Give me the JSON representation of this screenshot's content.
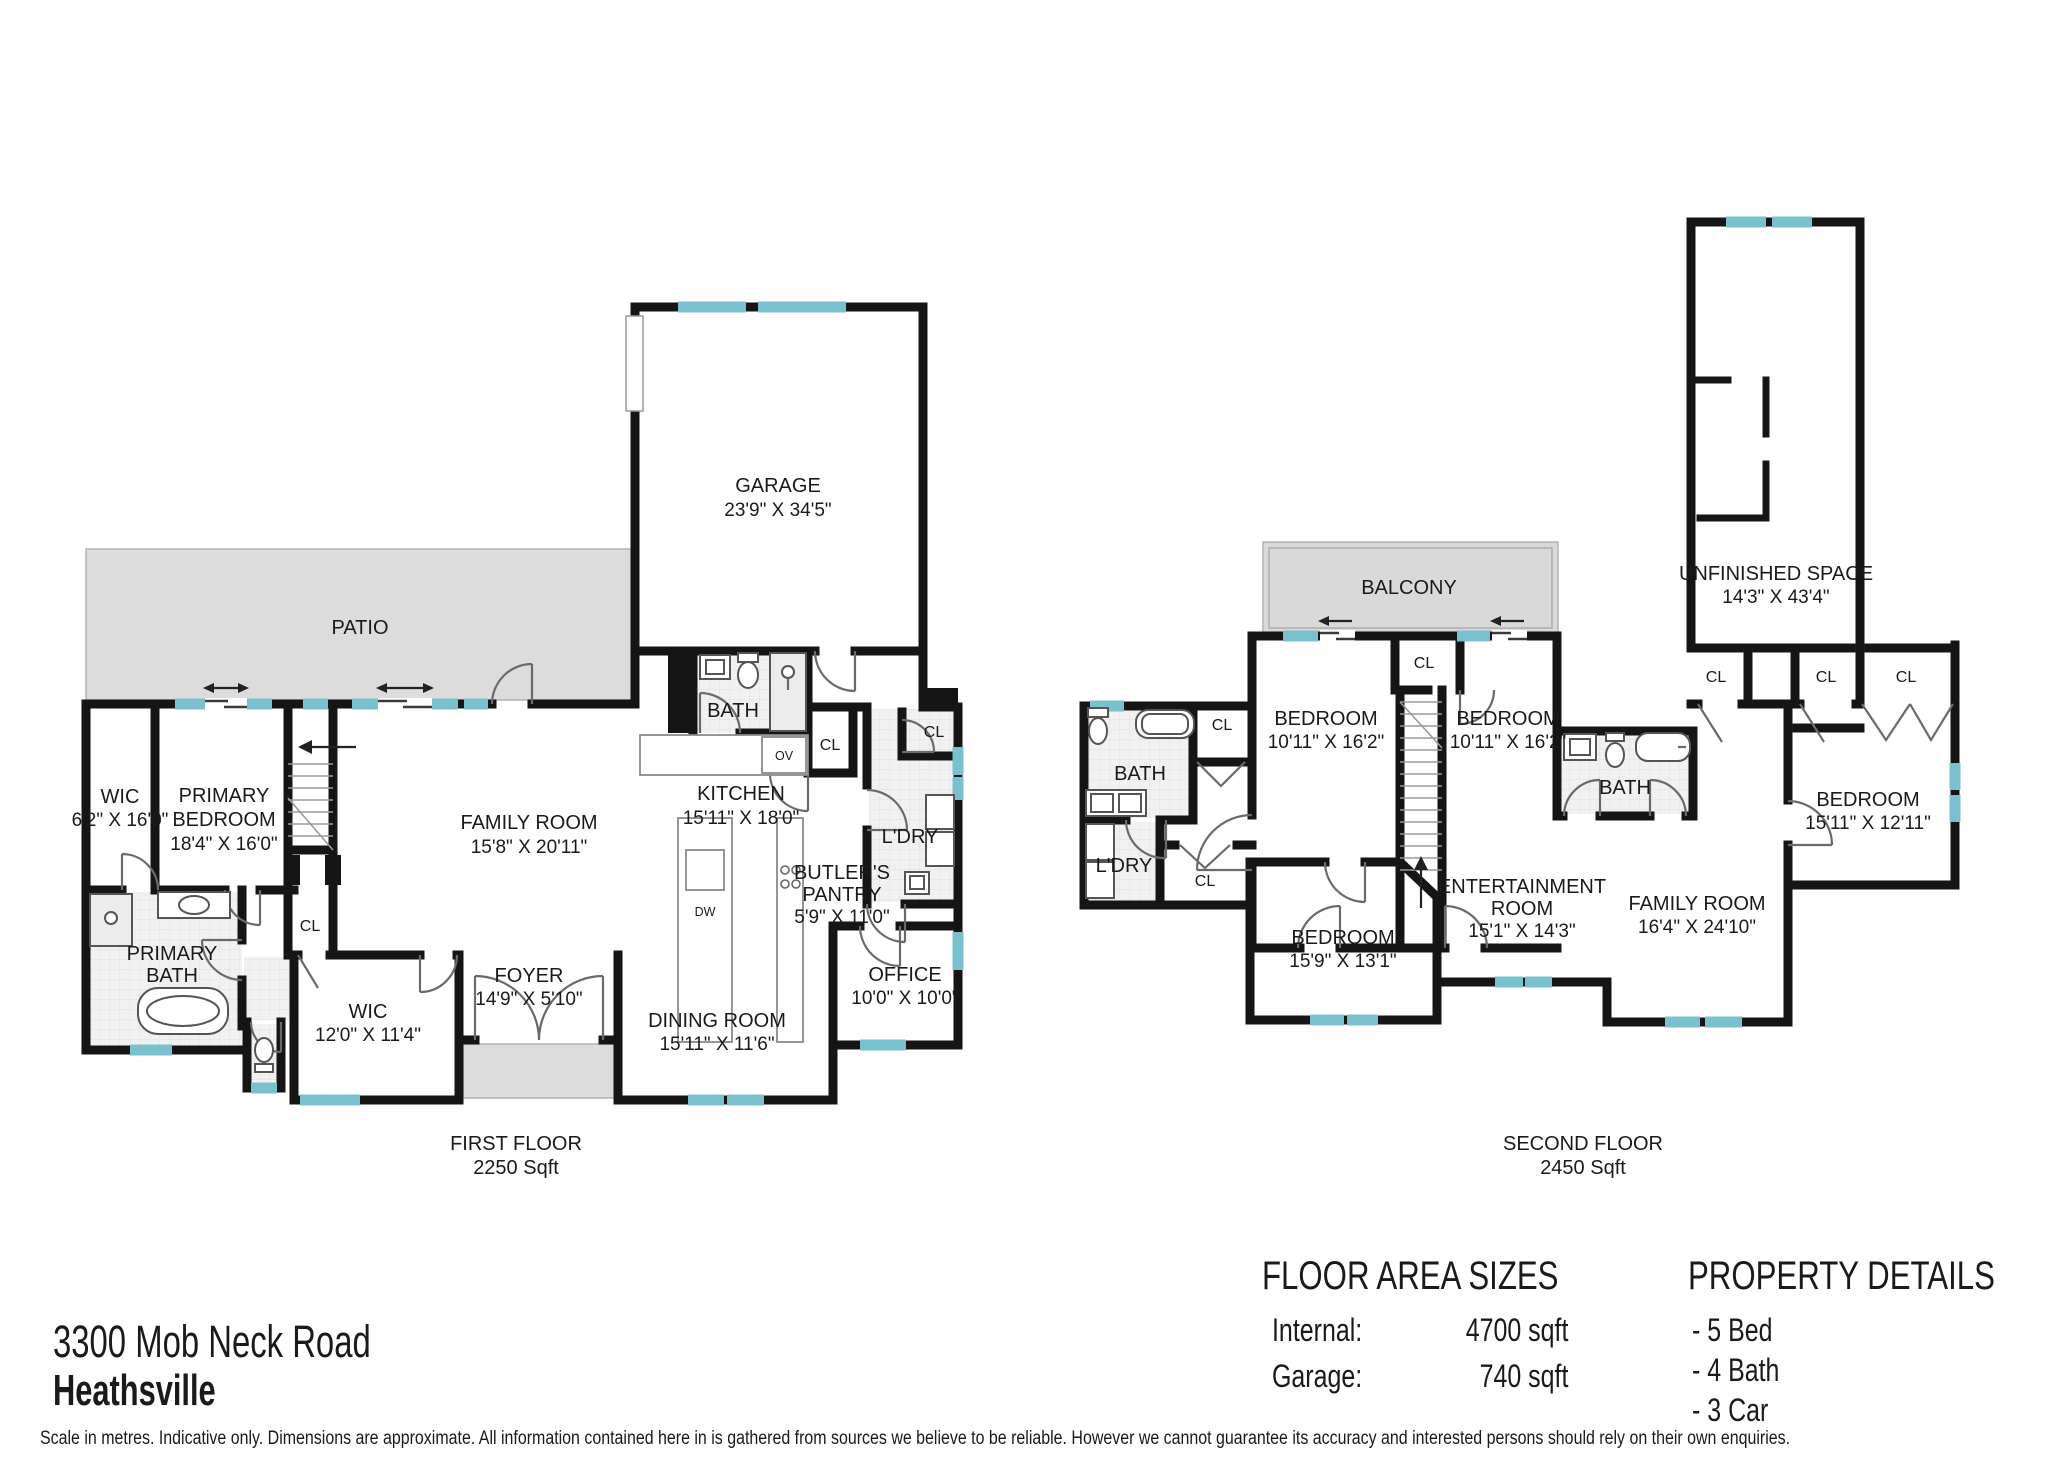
{
  "page_title": "Floor Plan",
  "colors": {
    "wall": "#151515",
    "window": "#79c1ce",
    "patio_fill": "#dcdcdd",
    "tile_fill": "#f1f1f1"
  },
  "address": {
    "line1": "3300 Mob Neck Road",
    "line2": "Heathsville"
  },
  "floor_area": {
    "title": "FLOOR AREA SIZES",
    "rows": [
      {
        "label": "Internal:",
        "value": "4700 sqft"
      },
      {
        "label": "Garage:",
        "value": "740 sqft"
      }
    ]
  },
  "property_details": {
    "title": "PROPERTY DETAILS",
    "items": [
      "- 5 Bed",
      "- 4 Bath",
      "- 3 Car"
    ]
  },
  "disclaimer": "Scale in metres. Indicative only. Dimensions are approximate. All information contained here in is gathered from sources we believe to be reliable. However we cannot guarantee its accuracy and interested persons should rely on their own enquiries.",
  "first_floor": {
    "title": "FIRST FLOOR",
    "area": "2250 Sqft",
    "rooms": {
      "patio": {
        "name": "PATIO"
      },
      "garage": {
        "name": "GARAGE",
        "dims": "23'9\" X 34'5\""
      },
      "bath": {
        "name": "BATH"
      },
      "oven": {
        "name": "OV"
      },
      "kitchen": {
        "name": "KITCHEN",
        "dims": "15'11\" X 18'0\""
      },
      "closet_a": {
        "name": "CL"
      },
      "closet_b": {
        "name": "CL"
      },
      "laundry": {
        "name": "L'DRY"
      },
      "butlers_pantry": {
        "name": "BUTLER'S PANTRY",
        "lines": [
          "BUTLER'S",
          "PANTRY"
        ],
        "dims": "5'9\" X 11'0\""
      },
      "dishwasher": {
        "name": "DW"
      },
      "family_room": {
        "name": "FAMILY ROOM",
        "dims": "15'8\" X 20'11\""
      },
      "primary_bedroom": {
        "name": "PRIMARY BEDROOM",
        "lines": [
          "PRIMARY",
          "BEDROOM"
        ],
        "dims": "18'4\" X 16'0\""
      },
      "wic_a": {
        "name": "WIC",
        "dims": "6'2\" X 16'0\""
      },
      "closet_stairs": {
        "name": "CL"
      },
      "primary_bath": {
        "name": "PRIMARY BATH",
        "lines": [
          "PRIMARY",
          "BATH"
        ]
      },
      "wic_b": {
        "name": "WIC",
        "dims": "12'0\" X 11'4\""
      },
      "foyer": {
        "name": "FOYER",
        "dims": "14'9\" X 5'10\""
      },
      "dining_room": {
        "name": "DINING ROOM",
        "dims": "15'11\" X 11'6\""
      },
      "office": {
        "name": "OFFICE",
        "dims": "10'0\" X 10'0\""
      }
    }
  },
  "second_floor": {
    "title": "SECOND FLOOR",
    "area": "2450 Sqft",
    "rooms": {
      "balcony": {
        "name": "BALCONY"
      },
      "bedroom_a": {
        "name": "BEDROOM",
        "dims": "10'11\" X 16'2\""
      },
      "closet_top": {
        "name": "CL"
      },
      "bedroom_b": {
        "name": "BEDROOM",
        "dims": "10'11\" X 16'2\""
      },
      "unfinished": {
        "name": "UNFINISHED SPACE",
        "dims": "14'3\" X 43'4\""
      },
      "closet_row_a": {
        "name": "CL"
      },
      "closet_row_b": {
        "name": "CL"
      },
      "closet_row_c": {
        "name": "CL"
      },
      "bath_a": {
        "name": "BATH"
      },
      "closet_bath": {
        "name": "CL"
      },
      "laundry": {
        "name": "L'DRY"
      },
      "closet_hall": {
        "name": "CL"
      },
      "bath_b": {
        "name": "BATH"
      },
      "bedroom_back": {
        "name": "BEDROOM",
        "dims": "15'9\" X 13'1\""
      },
      "entertainment": {
        "name": "ENTERTAINMENT ROOM",
        "lines": [
          "ENTERTAINMENT",
          "ROOM"
        ],
        "dims": "15'1\" X 14'3\""
      },
      "family_room": {
        "name": "FAMILY ROOM",
        "dims": "16'4\" X 24'10\""
      },
      "bedroom_right": {
        "name": "BEDROOM",
        "dims": "15'11\" X 12'11\""
      }
    }
  }
}
